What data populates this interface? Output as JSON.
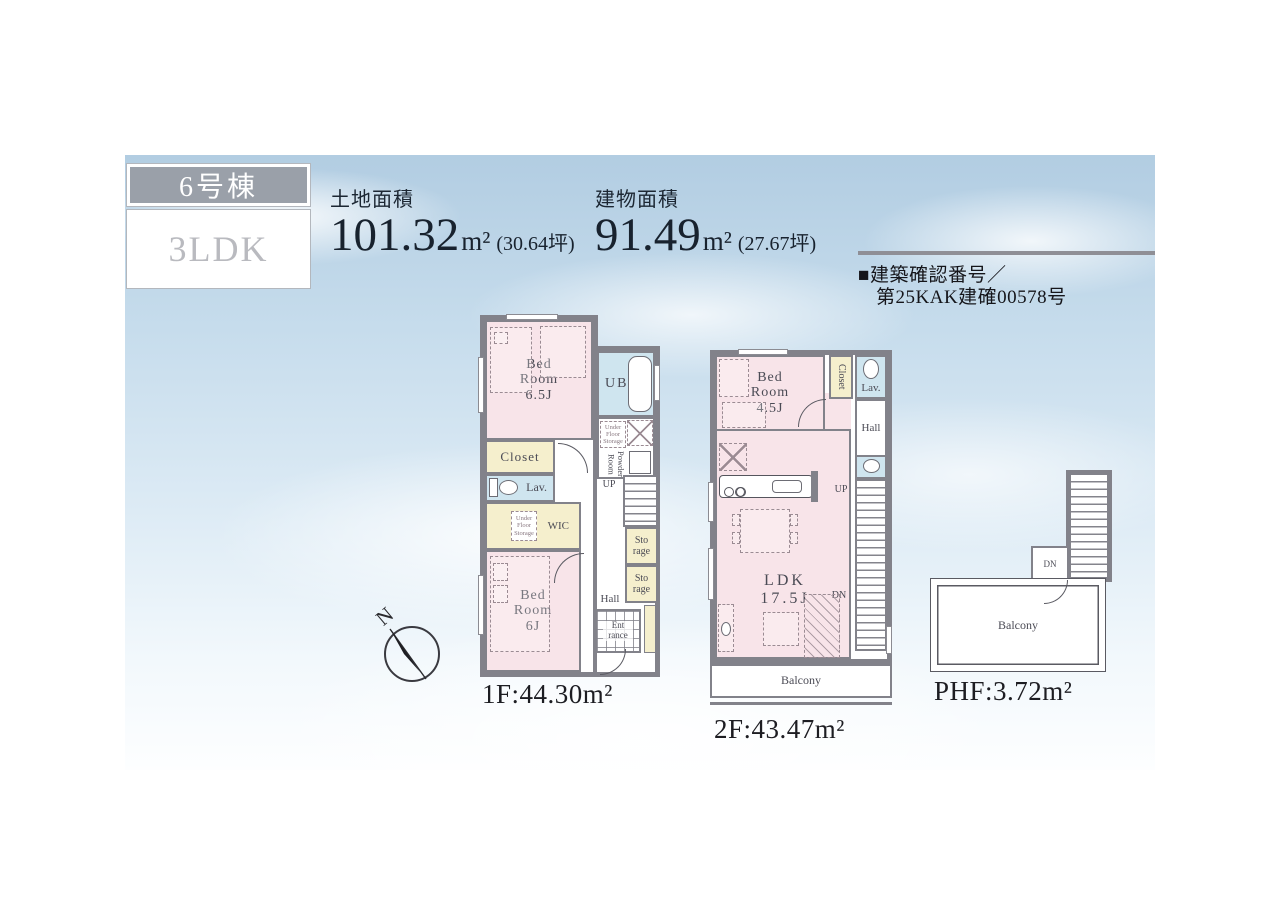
{
  "badge": {
    "building": "6号棟",
    "plan_type": "3LDK"
  },
  "summary": {
    "land": {
      "label": "土地面積",
      "value": "101.32",
      "unit": "m²",
      "tsubo": "(30.64坪)"
    },
    "building": {
      "label": "建物面積",
      "value": "91.49",
      "unit": "m²",
      "tsubo": "(27.67坪)"
    },
    "confirmation_line1": "■建築確認番号／",
    "confirmation_line2": "第25KAK建確00578号"
  },
  "compass": {
    "north": "N"
  },
  "floor1": {
    "area_label": "1F:44.30m²",
    "rooms": {
      "bedroom65": "Bed Room 6.5J",
      "ub": "UB",
      "under_floor_storage_a": "Under Floor Storage",
      "powder_room": "Powder Room",
      "closet": "Closet",
      "lav": "Lav.",
      "wic": "WIC",
      "under_floor_storage_b": "Under Floor Storage",
      "bedroom6": "Bed Room 6J",
      "up": "UP",
      "storage_a": "Sto rage",
      "storage_b": "Sto rage",
      "hall": "Hall",
      "entrance": "Ent rance"
    }
  },
  "floor2": {
    "area_label": "2F:43.47m²",
    "rooms": {
      "bedroom45": "Bed Room 4.5J",
      "closet": "Closet",
      "lav": "Lav.",
      "hall": "Hall",
      "up": "UP",
      "dn": "DN",
      "ldk": "LDK 17.5J",
      "balcony": "Balcony"
    }
  },
  "phf": {
    "area_label": "PHF:3.72m²",
    "rooms": {
      "dn": "DN",
      "balcony": "Balcony"
    }
  }
}
